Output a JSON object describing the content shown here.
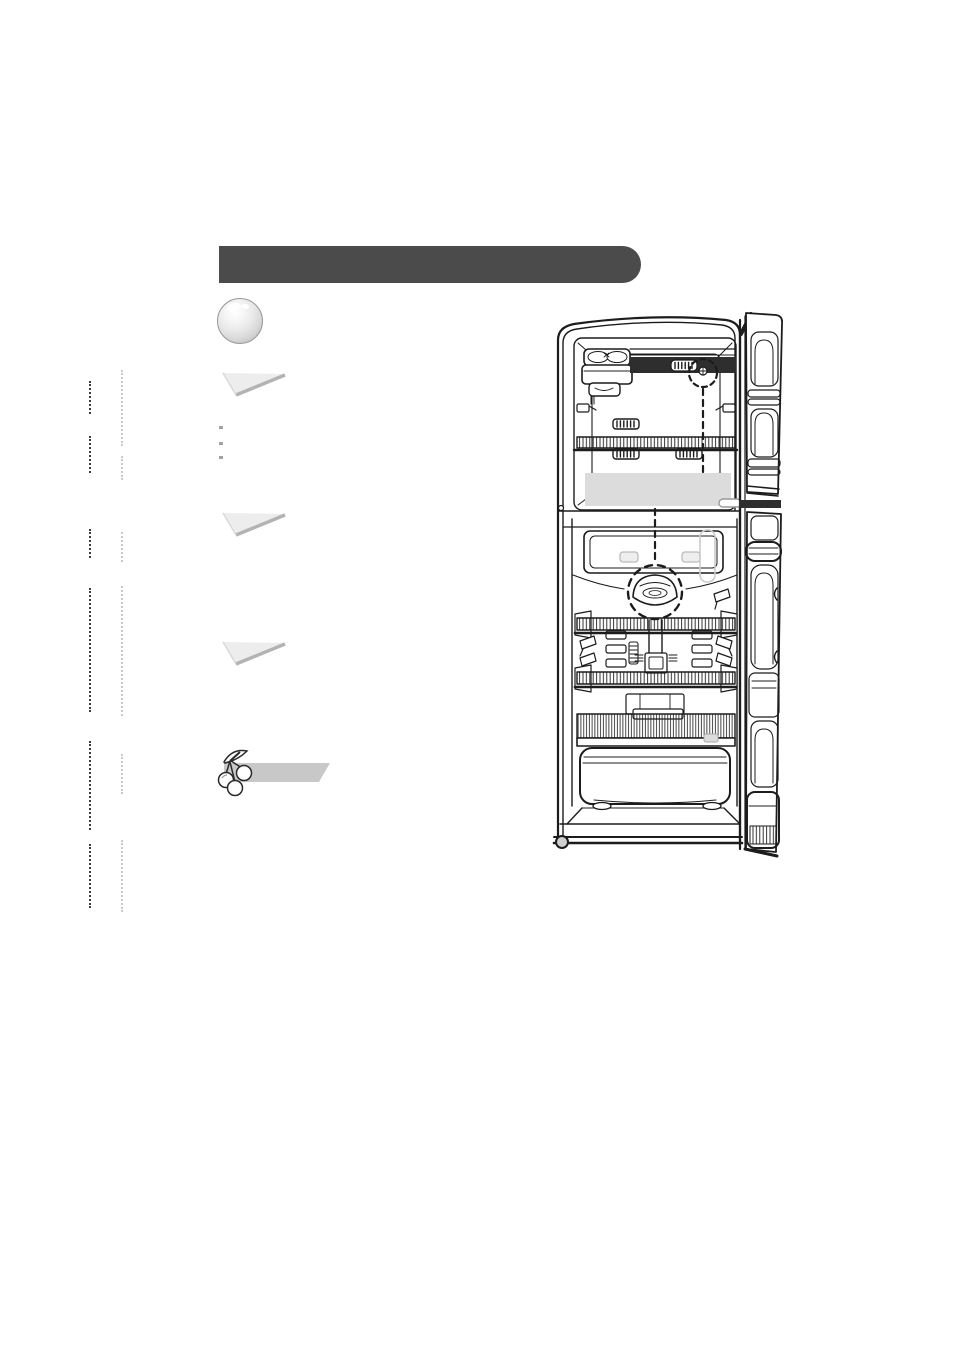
{
  "page": {
    "kind": "scanned-manual-page",
    "visible_text": ""
  },
  "colors": {
    "page_bg": "#ffffff",
    "header_bar": "#4b4b4b",
    "wedge_fill": "#ededed",
    "wedge_edge": "#b3b3b3",
    "bullet": "#a3a3a3",
    "note_bar": "#c8c8c8",
    "remnant_dark": "#3c3c3c",
    "remnant_light": "#c9c9c9",
    "line": "#1c1c1c",
    "redacted_band": "#dcdcdc",
    "dark_fill": "#2e2e2e",
    "gray_detail": "#bbbbbb",
    "chip_fill": "#eeeeee"
  },
  "icons": {
    "section_marker": "glossy-sphere-icon",
    "note_marker": "cherries-icon",
    "list_markers": "triangle-wedge-icon"
  },
  "figure": {
    "kind": "refrigerator-open-door-line-drawing",
    "labels_visible": ""
  }
}
